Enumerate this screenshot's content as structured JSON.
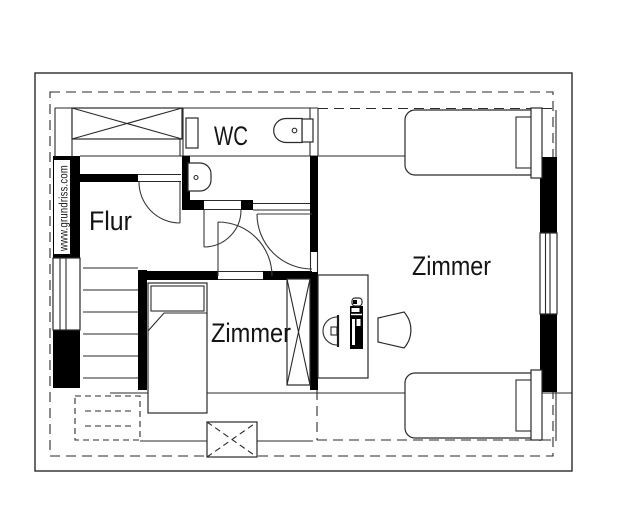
{
  "page": {
    "background": "#ffffff",
    "line_color": "#2a2a2a",
    "wall_color": "#000000",
    "text_color": "#141414"
  },
  "plan": {
    "watermark": "www.grundriss.com",
    "rooms": [
      {
        "id": "wc",
        "label": "WC"
      },
      {
        "id": "flur",
        "label": "Flur"
      },
      {
        "id": "zimmer-small",
        "label": "Zimmer"
      },
      {
        "id": "zimmer-large",
        "label": "Zimmer"
      }
    ]
  }
}
